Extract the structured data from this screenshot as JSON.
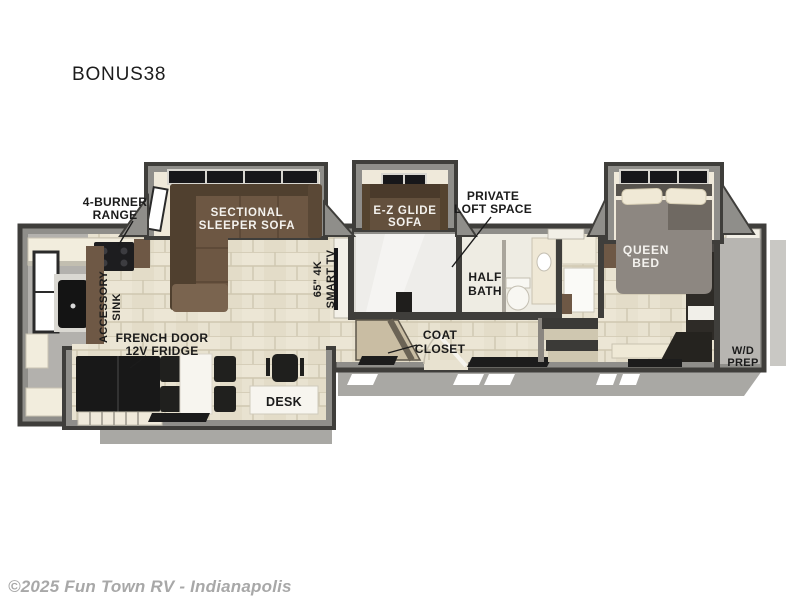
{
  "page": {
    "background": "#ffffff"
  },
  "title": "BONUS38",
  "watermark": "©2025 Fun Town RV - Indianapolis",
  "floorplan": {
    "model": "BONUS38",
    "labels": {
      "burner_range": {
        "line1": "4-BURNER",
        "line2": "RANGE"
      },
      "sectional_sofa": {
        "line1": "SECTIONAL",
        "line2": "SLEEPER SOFA"
      },
      "ez_glide_sofa": {
        "line1": "E-Z GLIDE",
        "line2": "SOFA"
      },
      "private_loft": {
        "line1": "PRIVATE",
        "line2": "LOFT SPACE"
      },
      "smart_tv": {
        "line1": "65\" 4K",
        "line2": "SMART TV"
      },
      "half_bath": {
        "line1": "HALF",
        "line2": "BATH"
      },
      "queen_bed": {
        "line1": "QUEEN",
        "line2": "BED"
      },
      "accessory_sink": {
        "line1": "ACCESSORY",
        "line2": "SINK"
      },
      "fridge": {
        "line1": "FRENCH DOOR",
        "line2": "12V FRIDGE"
      },
      "coat_closet": {
        "line1": "COAT",
        "line2": "CLOSET"
      },
      "desk": "DESK",
      "wd_prep": {
        "line1": "W/D",
        "line2": "PREP"
      }
    },
    "colors": {
      "wall_dark": "#3f3e3b",
      "wall_gray": "#8f8e8a",
      "floor_tile": "#e8e2d0",
      "tile_line": "#cfc7b0",
      "slide_floor": "#efe9da",
      "sofa_brown": "#6d5743",
      "sofa_dark": "#50402f",
      "counter_cream": "#f2eddd",
      "counter_brown": "#6e5845",
      "appliance_black": "#1c1c1c",
      "front_cap_gray": "#b3b1ad",
      "ground_gray": "#a9a8a4",
      "loft_floor": "#dddbd5",
      "bed_gray": "#8d8781",
      "label_black": "#1b1b1b",
      "label_white": "#f4f2ee"
    }
  }
}
